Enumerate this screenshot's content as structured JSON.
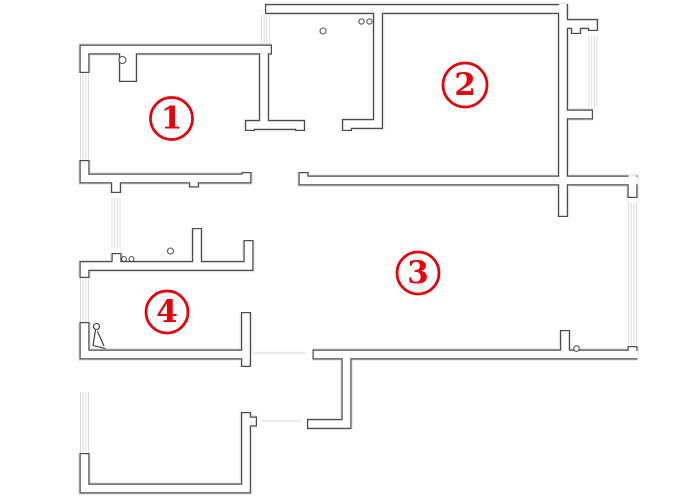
{
  "floorplan": {
    "width": 700,
    "height": 500,
    "style": {
      "background": "#ffffff",
      "wall_stroke": "#4a4a4a",
      "wall_fill": "#ffffff",
      "halo": "#e4e4e4",
      "window_line": "#dcdcdc",
      "faint_line": "#ededed",
      "symbol_stroke": "#555555",
      "label_red": "#e8000a"
    },
    "rooms": [
      {
        "label": "1",
        "cx": 171.5,
        "cy": 118.5,
        "r": 21
      },
      {
        "label": "2",
        "cx": 465,
        "cy": 85,
        "r": 22
      },
      {
        "label": "3",
        "cx": 418,
        "cy": 273,
        "r": 21
      },
      {
        "label": "4",
        "cx": 167,
        "cy": 312,
        "r": 21
      }
    ],
    "walls": {
      "thickness": 10,
      "outline": 1.2,
      "polylines": [
        {
          "pts": [
            [
              265,
              9
            ],
            [
              568,
              9
            ]
          ],
          "t": 10
        },
        {
          "pts": [
            [
              563,
              4
            ],
            [
              563,
              217
            ]
          ],
          "t": 10
        },
        {
          "pts": [
            [
              563,
              24
            ],
            [
              593,
              24
            ],
            [
              593,
              31
            ]
          ],
          "t": 10
        },
        {
          "pts": [
            [
              576,
              24
            ],
            [
              576,
              34
            ]
          ],
          "t": 10
        },
        {
          "pts": [
            [
              563,
              114.5
            ],
            [
              593,
              114.5
            ]
          ],
          "t": 10
        },
        {
          "pts": [
            [
              378,
              8
            ],
            [
              378,
              124
            ],
            [
              347,
              124
            ],
            [
              347,
              131
            ]
          ],
          "t": 10
        },
        {
          "pts": [
            [
              84.5,
              73
            ],
            [
              84.5,
              49.5
            ],
            [
              272,
              49.5
            ]
          ],
          "t": 10
        },
        {
          "pts": [
            [
              264,
              52
            ],
            [
              264,
              125
            ]
          ],
          "t": 10
        },
        {
          "pts": [
            [
              250,
              131
            ],
            [
              250,
              125
            ],
            [
              300,
              125
            ],
            [
              300,
              131
            ]
          ],
          "t": 10
        },
        {
          "pts": [
            [
              84.5,
              160
            ],
            [
              84.5,
              178.5
            ],
            [
              246.5,
              178.5
            ],
            [
              246.5,
              172
            ]
          ],
          "t": 10
        },
        {
          "pts": [
            [
              116,
              178.5
            ],
            [
              116,
              193
            ]
          ],
          "t": 10
        },
        {
          "pts": [
            [
              194,
              178.5
            ],
            [
              194,
              187.5
            ]
          ],
          "t": 10
        },
        {
          "pts": [
            [
              303.5,
              172
            ],
            [
              303.5,
              180.5
            ],
            [
              637.5,
              180.5
            ]
          ],
          "t": 10
        },
        {
          "pts": [
            [
              632.5,
              175.5
            ],
            [
              632.5,
              198
            ]
          ],
          "t": 10
        },
        {
          "pts": [
            [
              84.5,
              278
            ],
            [
              84.5,
              266
            ],
            [
              248.5,
              266
            ],
            [
              248.5,
              240
            ]
          ],
          "t": 10
        },
        {
          "pts": [
            [
              116.5,
              266
            ],
            [
              116.5,
              253
            ]
          ],
          "t": 10
        },
        {
          "pts": [
            [
              197,
              266
            ],
            [
              197,
              228
            ]
          ],
          "t": 10
        },
        {
          "pts": [
            [
              84.5,
              322
            ],
            [
              84.5,
              354.5
            ],
            [
              246,
              354.5
            ]
          ],
          "t": 10
        },
        {
          "pts": [
            [
              246,
              312
            ],
            [
              246,
              367
            ]
          ],
          "t": 10
        },
        {
          "pts": [
            [
              84.5,
              453
            ],
            [
              84.5,
              488.5
            ],
            [
              246,
              488.5
            ],
            [
              246,
              412
            ]
          ],
          "t": 10
        },
        {
          "pts": [
            [
              246,
              421.5
            ],
            [
              257,
              421.5
            ]
          ],
          "t": 10
        },
        {
          "pts": [
            [
              312.5,
              354.5
            ],
            [
              637.5,
              354.5
            ]
          ],
          "t": 10
        },
        {
          "pts": [
            [
              632.5,
              354.5
            ],
            [
              632.5,
              347
            ]
          ],
          "t": 10
        },
        {
          "pts": [
            [
              565,
              354.5
            ],
            [
              565,
              330
            ]
          ],
          "t": 10
        },
        {
          "pts": [
            [
              346.5,
              354.5
            ],
            [
              346.5,
              424
            ],
            [
              307,
              424
            ]
          ],
          "t": 10
        },
        {
          "pts": [
            [
              128,
              50
            ],
            [
              128,
              82
            ]
          ],
          "t": 18
        }
      ],
      "caps": [
        [
          265.6,
          4,
          265.6,
          14
        ],
        [
          567.4,
          4,
          567.4,
          14
        ],
        [
          558,
          216.4,
          568,
          216.4
        ],
        [
          588,
          30.4,
          598,
          30.4
        ],
        [
          571,
          33.4,
          581,
          33.4
        ],
        [
          592.4,
          109.5,
          592.4,
          119.5
        ],
        [
          342,
          130.4,
          352,
          130.4
        ],
        [
          79.5,
          72.4,
          89.5,
          72.4
        ],
        [
          271.4,
          44.5,
          271.4,
          54.5
        ],
        [
          245,
          130.4,
          255,
          130.4
        ],
        [
          295,
          130.4,
          305,
          130.4
        ],
        [
          79.5,
          160.6,
          89.5,
          160.6
        ],
        [
          241.5,
          172.6,
          251.5,
          172.6
        ],
        [
          111,
          192.4,
          121,
          192.4
        ],
        [
          189,
          186.9,
          199,
          186.9
        ],
        [
          298.5,
          172.6,
          308.5,
          172.6
        ],
        [
          627.5,
          197.4,
          637.5,
          197.4
        ],
        [
          79.5,
          277.4,
          89.5,
          277.4
        ],
        [
          243.5,
          240.6,
          253.5,
          240.6
        ],
        [
          111.5,
          253.6,
          121.5,
          253.6
        ],
        [
          192,
          228.6,
          202,
          228.6
        ],
        [
          79.5,
          322.6,
          89.5,
          322.6
        ],
        [
          241,
          312.6,
          251,
          312.6
        ],
        [
          241,
          366.4,
          251,
          366.4
        ],
        [
          79.5,
          453.6,
          89.5,
          453.6
        ],
        [
          241,
          412.6,
          251,
          412.6
        ],
        [
          256.4,
          416.5,
          256.4,
          426.5
        ],
        [
          313.1,
          349.5,
          313.1,
          359.5
        ],
        [
          627.5,
          346.6,
          637.5,
          346.6
        ],
        [
          560,
          330.6,
          570,
          330.6
        ],
        [
          307.6,
          419,
          307.6,
          429
        ],
        [
          119,
          81.4,
          137,
          81.4
        ]
      ]
    },
    "windows": [
      {
        "x": 261.5,
        "y": 14.5,
        "len": 29,
        "band": 8,
        "dir": "v"
      },
      {
        "x": 80.5,
        "y": 73.5,
        "len": 86,
        "band": 8,
        "dir": "v"
      },
      {
        "x": 112,
        "y": 198,
        "len": 50,
        "band": 8,
        "dir": "v"
      },
      {
        "x": 80.5,
        "y": 277.5,
        "len": 45,
        "band": 8,
        "dir": "v"
      },
      {
        "x": 80.5,
        "y": 392,
        "len": 61,
        "band": 8,
        "dir": "v"
      },
      {
        "x": 589,
        "y": 35.5,
        "len": 71,
        "band": 8,
        "dir": "v"
      },
      {
        "x": 628.5,
        "y": 202.5,
        "len": 143,
        "band": 8,
        "dir": "v"
      }
    ],
    "door_dots": [
      [
        122.5,
        60,
        3.5
      ],
      [
        323,
        31,
        3
      ],
      [
        361.5,
        21.5,
        2.6
      ],
      [
        369.5,
        21.5,
        2.6
      ],
      [
        124,
        259,
        2.4
      ],
      [
        131.5,
        259,
        2.4
      ],
      [
        170.5,
        251,
        3
      ],
      [
        576.5,
        348.5,
        2.8
      ]
    ],
    "fixture": {
      "dot": [
        96.5,
        326.5,
        3
      ],
      "paths": [
        "M95.5,330 L93,345.5 L105.5,348.5",
        "M97.5,331.5 L104,346"
      ]
    },
    "faint_lines": [
      [
        253,
        353,
        306,
        353
      ],
      [
        262,
        421,
        301,
        421
      ]
    ]
  }
}
